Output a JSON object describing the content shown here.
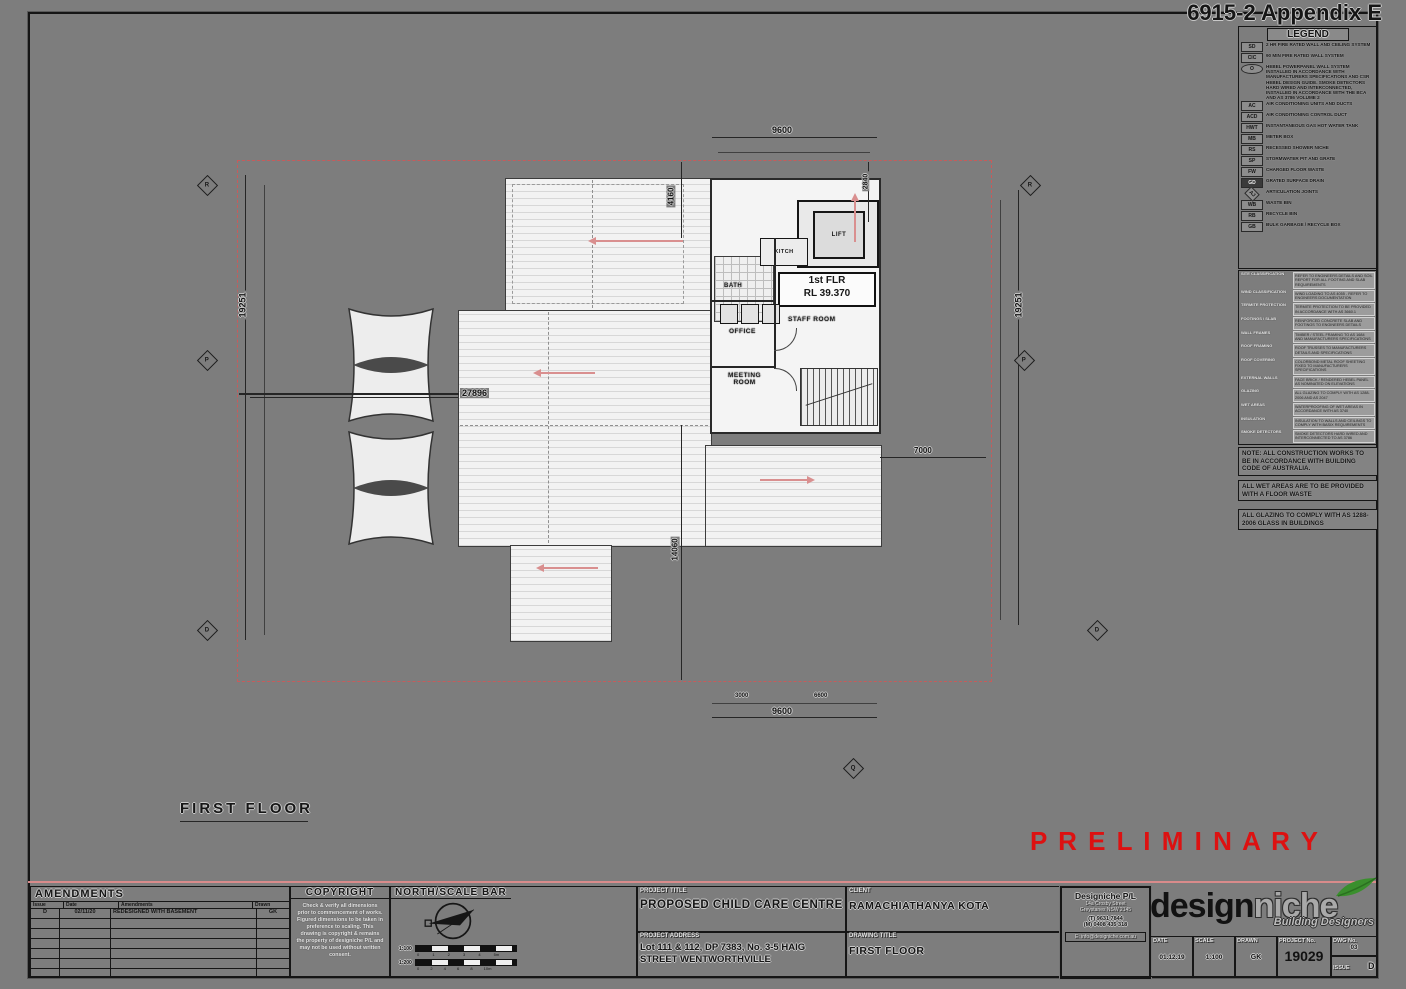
{
  "frame": {
    "appendix": "6915-2 Appendix E"
  },
  "plan": {
    "title": "FIRST FLOOR",
    "preliminary": "P R E L I M I N A R Y",
    "level1": "1st FLR",
    "level2": "RL 39.370",
    "rooms": {
      "lift": "LIFT",
      "kitchen": "KITCH",
      "bath": "BATH",
      "office": "OFFICE",
      "staff": "STAFF ROOM",
      "meeting1": "MEETING",
      "meeting2": "ROOM"
    },
    "dims": {
      "top": "9600",
      "bottom": "9600",
      "left": "19251",
      "right": "19251",
      "width": "27896",
      "wing": "7000",
      "mid_v": "14060",
      "top_v": "4160",
      "lift_v": "2840",
      "sub_b1": "3000",
      "sub_b2": "6600"
    },
    "markers": [
      "R",
      "P",
      "D",
      "R",
      "P",
      "D",
      "Q"
    ]
  },
  "legend": {
    "title": "LEGEND",
    "items": [
      {
        "sym": "SD",
        "text": "2 HR FIRE RATED WALL AND CEILING SYSTEM"
      },
      {
        "sym": "CIC",
        "text": "90 MIN FIRE RATED WALL SYSTEM"
      },
      {
        "sym": "O",
        "text": "HEBEL POWERPANEL WALL SYSTEM INSTALLED IN ACCORDANCE WITH MANUFACTURERS SPECIFICATIONS AND CSR HEBEL DESIGN GUIDE. SMOKE DETECTORS HARD WIRED AND INTERCONNECTED, INSTALLED IN ACCORDANCE WITH THE BCA AND AS 3786 VOLUME 2"
      },
      {
        "sym": "AC",
        "text": "AIR CONDITIONING UNITS AND DUCTS"
      },
      {
        "sym": "ACD",
        "text": "AIR CONDITIONING CONTROL DUCT"
      },
      {
        "sym": "HWT",
        "text": "INSTANTANEOUS GAS HOT WATER TANK"
      },
      {
        "sym": "MB",
        "text": "METER BOX"
      },
      {
        "sym": "RS",
        "text": "RECESSED SHOWER NICHE"
      },
      {
        "sym": "SP",
        "text": "STORMWATER PIT AND GRATE"
      },
      {
        "sym": "FW",
        "text": "CHARGED FLOOR WASTE"
      },
      {
        "sym": "GD",
        "text": "GRATED SURFACE DRAIN"
      },
      {
        "sym": "AJ",
        "text": "ARTICULATION JOINTS"
      },
      {
        "sym": "WB",
        "text": "WASTE BIN"
      },
      {
        "sym": "RB",
        "text": "RECYCLE BIN"
      },
      {
        "sym": "GB",
        "text": "BULK GARBAGE / RECYCLE BOX"
      }
    ]
  },
  "specs": {
    "rows": [
      {
        "label": "SITE CLASSIFICATION",
        "text": "REFER TO ENGINEERS DETAILS AND SOIL REPORT FOR ALL FOOTING AND SLAB REQUIREMENTS"
      },
      {
        "label": "WIND CLASSIFICATION",
        "text": "WIND LOADING TO AS 4055 - REFER TO ENGINEERS DOCUMENTATION"
      },
      {
        "label": "TERMITE PROTECTION",
        "text": "TERMITE PROTECTION TO BE PROVIDED IN ACCORDANCE WITH AS 3660.1"
      },
      {
        "label": "FOOTINGS / SLAB",
        "text": "REINFORCED CONCRETE SLAB AND FOOTINGS TO ENGINEERS DETAILS"
      },
      {
        "label": "WALL FRAMES",
        "text": "TIMBER / STEEL FRAMING TO AS 1684 AND MANUFACTURERS SPECIFICATIONS"
      },
      {
        "label": "ROOF FRAMING",
        "text": "ROOF TRUSSES TO MANUFACTURERS DETAILS AND SPECIFICATIONS"
      },
      {
        "label": "ROOF COVERING",
        "text": "COLORBOND METAL ROOF SHEETING FIXED TO MANUFACTURERS SPECIFICATIONS"
      },
      {
        "label": "EXTERNAL WALLS",
        "text": "FACE BRICK / RENDERED HEBEL PANEL AS NOMINATED ON ELEVATIONS"
      },
      {
        "label": "GLAZING",
        "text": "ALL GLAZING TO COMPLY WITH AS 1288-2006 AND AS 2047"
      },
      {
        "label": "WET AREAS",
        "text": "WATERPROOFING OF WET AREAS IN ACCORDANCE WITH AS 3740"
      },
      {
        "label": "INSULATION",
        "text": "INSULATION TO WALLS AND CEILINGS TO COMPLY WITH BASIX REQUIREMENTS"
      },
      {
        "label": "SMOKE DETECTORS",
        "text": "SMOKE DETECTORS HARD WIRED AND INTERCONNECTED TO AS 3786"
      }
    ]
  },
  "notes": [
    "NOTE: ALL CONSTRUCTION WORKS TO BE IN ACCORDANCE WITH BUILDING CODE OF AUSTRALIA.",
    "ALL WET AREAS ARE TO BE PROVIDED WITH A FLOOR WASTE",
    "ALL GLAZING TO COMPLY WITH AS 1288-2006 GLASS IN BUILDINGS"
  ],
  "title_block": {
    "amendments": {
      "title": "AMENDMENTS",
      "headers": [
        "Issue",
        "Date",
        "Amendments",
        "Drawn"
      ],
      "row1": {
        "issue": "D",
        "date": "02/11/20",
        "text": "REDESIGNED WITH BASEMENT",
        "drawn": "GK"
      }
    },
    "copyright": {
      "title": "COPYRIGHT",
      "text": "Check & verify all dimensions prior to commencement of works. Figured dimensions to be taken in preference to scaling. This drawing is copyright & remains the property of designiche P/L and may not be used without written consent."
    },
    "north": {
      "title": "NORTH/SCALE BAR",
      "scale1": "1:100",
      "scale1_marks": "0 1 2 3 4 5m",
      "scale2": "1:200",
      "scale2_marks": "0 2 4 6 8 10m"
    },
    "project_title_label": "PROJECT TITLE",
    "project_title": "PROPOSED CHILD CARE CENTRE",
    "address_label": "PROJECT ADDRESS",
    "address": "Lot 111 & 112, DP 7383, No. 3-5 HAIG STREET WENTWORTHVILLE",
    "client_label": "CLIENT",
    "client": "RAMACHIATHANYA KOTA",
    "drawing_title_label": "DRAWING TITLE",
    "drawing_title": "FIRST FLOOR",
    "firm": {
      "name": "Designiche P/L",
      "addr1": "14a Crosby Street",
      "addr2": "Greystanes NSW 2145",
      "phone": "(T) 9631 7844",
      "mobile": "(M) 0408 435 318",
      "email": "E: info@designiche.com.au"
    },
    "logo": {
      "part1": "design",
      "part2": "niche",
      "subtitle": "Building Designers"
    },
    "fields": {
      "date_label": "DATE",
      "date": "01.12.19",
      "scale_label": "SCALE",
      "scale": "1:100",
      "drawn_label": "DRAWN",
      "drawn": "GK",
      "project_no_label": "PROJECT No.",
      "project_no": "19029",
      "dwg_no_label": "DWG No.",
      "dwg_no": "03",
      "issue_label": "ISSUE",
      "issue": "D"
    }
  },
  "colors": {
    "preliminary_red": "#dd1111",
    "boundary_red": "#c75b5b",
    "leaf_green": "#3a8f2d"
  }
}
